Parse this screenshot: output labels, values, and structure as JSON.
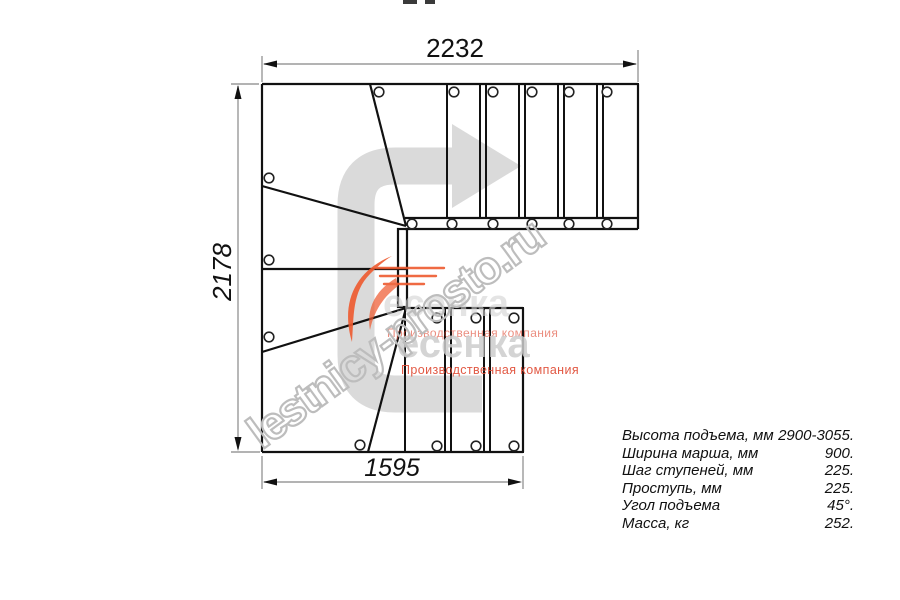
{
  "drawing_dimensions": {
    "top_width_mm": "2232",
    "left_height_mm": "2178",
    "bottom_width_mm": "1595"
  },
  "specs": {
    "rows": [
      {
        "label": "Высота подъема, мм",
        "value": "2900-3055."
      },
      {
        "label": "Ширина марша, мм",
        "value": "900."
      },
      {
        "label": "Шаг ступеней, мм",
        "value": "225."
      },
      {
        "label": "Проступь, мм",
        "value": "225."
      },
      {
        "label": "Угол подъема",
        "value": "45°."
      },
      {
        "label": "Масса, кг",
        "value": "252."
      }
    ]
  },
  "watermark": {
    "site_text": "lestnicy-prosto.ru",
    "brand_text": "есенка",
    "brand_subtitle": "Производственная компания"
  },
  "colors": {
    "line": "#111111",
    "dimension_line": "#9a9a9a",
    "direction_arrow": "#dadada",
    "watermark_outline": "#bdbdbd",
    "brand_gray": "#d2d2d2",
    "brand_red": "#e0503a",
    "swoosh_orange": "#ee5a2f"
  }
}
